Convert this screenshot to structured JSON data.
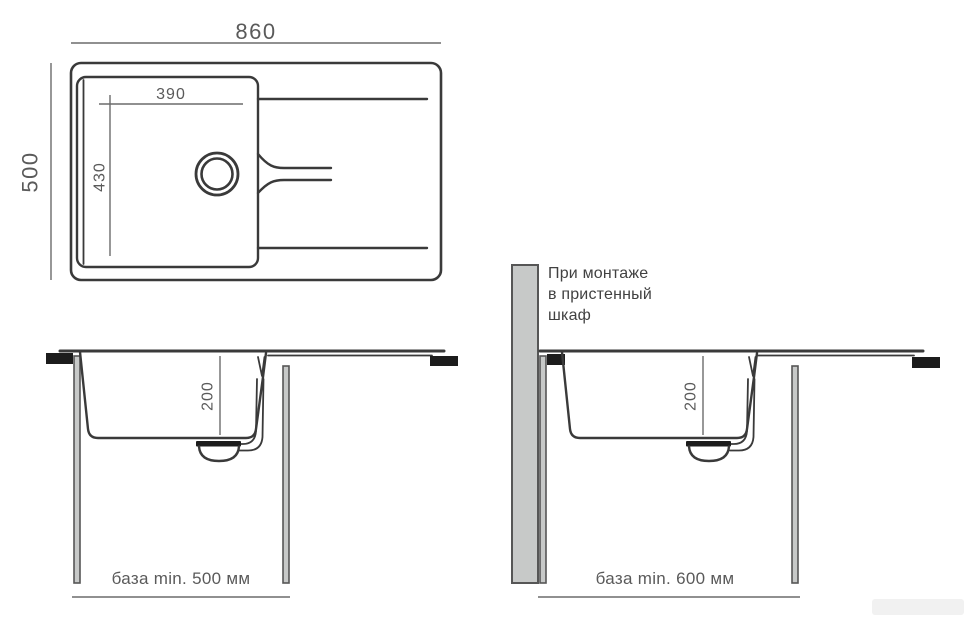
{
  "diagram": {
    "top_view": {
      "width_label": "860",
      "depth_label": "500",
      "bowl_width_label": "390",
      "bowl_depth_label": "430"
    },
    "front_view_straight": {
      "bowl_depth_label": "200",
      "cabinet_label": "база min. 500 мм"
    },
    "front_view_wall_cabinet": {
      "bowl_depth_label": "200",
      "cabinet_label": "база min. 600 мм",
      "note_lines": [
        "При монтаже",
        "в пристенный",
        "шкаф"
      ]
    },
    "colors": {
      "line": "#3a3a3a",
      "dim": "#6b6b6b",
      "text": "#5a5a5a",
      "note": "#414141",
      "panel_fill": "#c7c9c8",
      "panel_stroke": "#565656",
      "clamp": "#1c1c1c",
      "background": "#ffffff"
    }
  }
}
